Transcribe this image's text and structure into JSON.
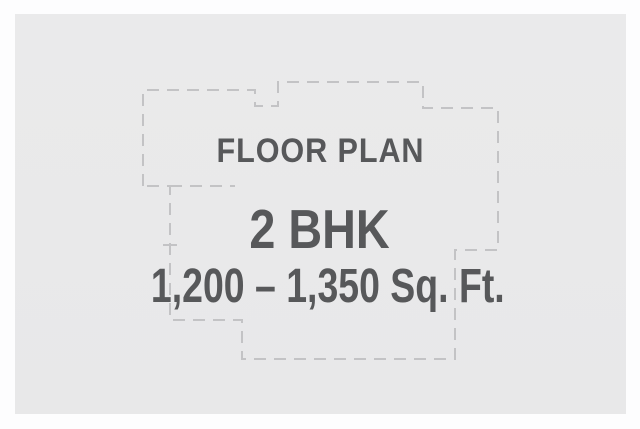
{
  "card": {
    "heading": "FLOOR PLAN",
    "unit_type": "2 BHK",
    "area_range": "1,200 – 1,350 Sq. Ft."
  },
  "colors": {
    "frame_background": "#fdfdfe",
    "panel_background": "#e9e9ea",
    "text": "#57585a",
    "outline_dash": "#c3c3c5"
  }
}
